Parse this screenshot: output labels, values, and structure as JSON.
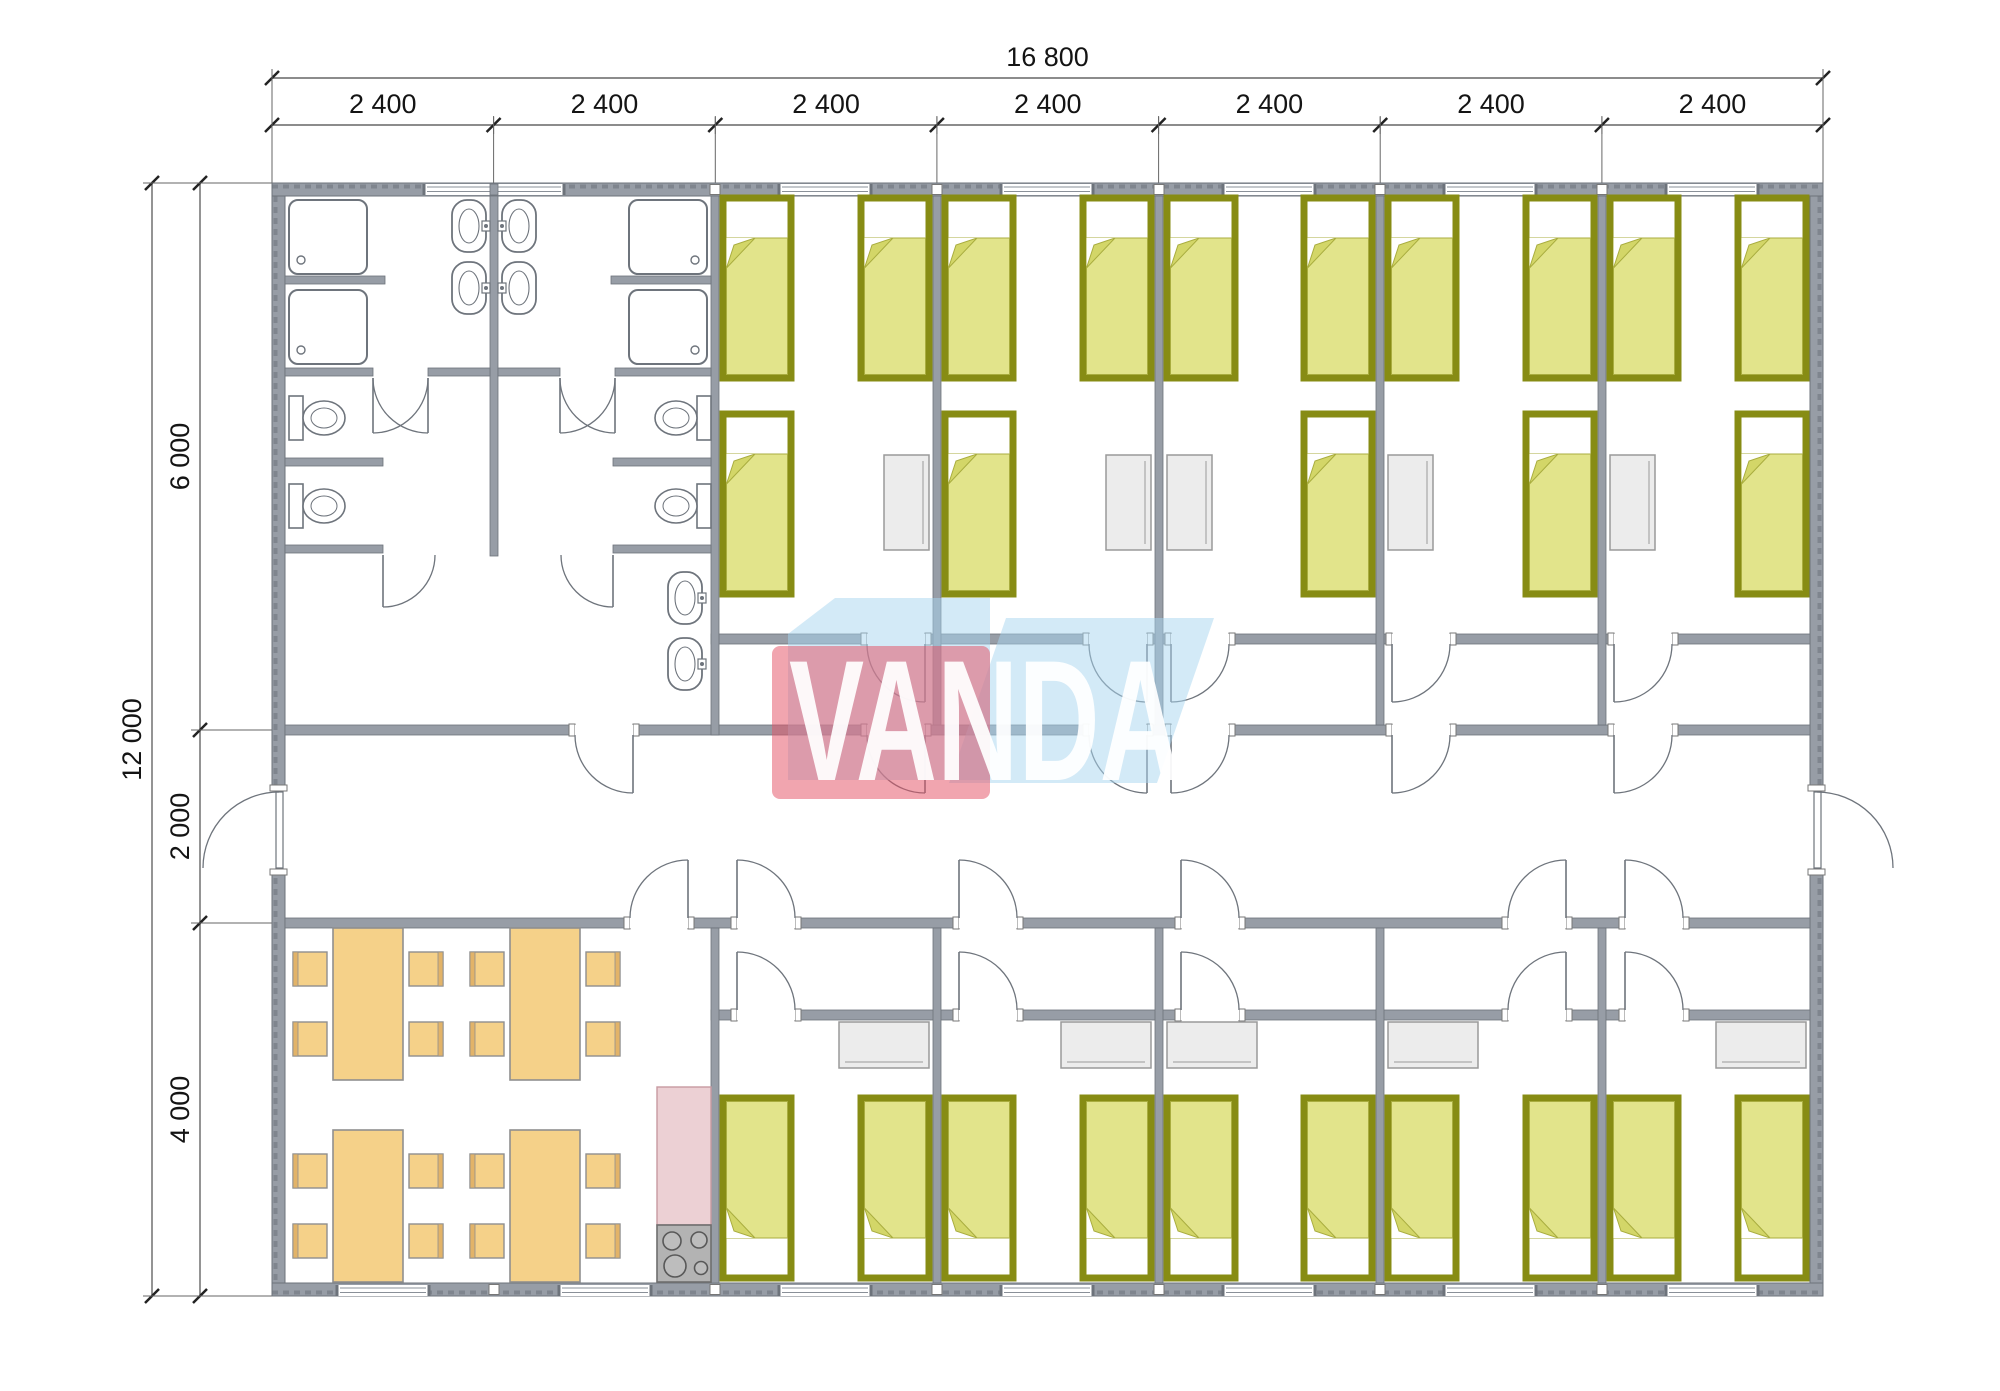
{
  "dimensions": {
    "top_total": "16 800",
    "top_segments": [
      "2 400",
      "2 400",
      "2 400",
      "2 400",
      "2 400",
      "2 400",
      "2 400"
    ],
    "left_total": "12 000",
    "left_segments": [
      "6 000",
      "2 000",
      "4 000"
    ]
  },
  "logo": {
    "text": "VANDA",
    "red": "rgba(228,82,102,0.52)",
    "blue": "rgba(168,214,240,0.50)",
    "text_color": "rgba(255,255,255,0.93)"
  },
  "colors": {
    "wall": "#979da6",
    "wall_edge": "#6d737b",
    "fixture": "#6e747c",
    "bed_frame": "#878c14",
    "bed_fill": "#e2e48b",
    "bed_fold": "#d3d668",
    "bed_fill_edge": "#a9ad3f",
    "gray_furn": "#ececec",
    "gray_furn_edge": "#9a9a9a",
    "dining": "#f5d189",
    "dining_edge": "#8f8f8f",
    "chair_back": "#e2b368",
    "kitchen": "#ecd0d4",
    "kitchen_edge": "#c79aa1",
    "stove": "#b3b3b3",
    "stove_edge": "#6e6e6e",
    "burner": "#bdbdbd",
    "burner_edge": "#585858",
    "dim_text": "#141414",
    "dim_line": "#666",
    "tick": "#222",
    "window_line": "#8a9098"
  },
  "plan": {
    "outer_walls": [
      [
        272,
        183,
        1551,
        13
      ],
      [
        272,
        1283,
        1551,
        13
      ],
      [
        272,
        196,
        13,
        1087
      ],
      [
        1810,
        196,
        13,
        1087
      ]
    ],
    "inner_walls": [
      [
        711,
        634,
        156,
        10
      ],
      [
        925,
        634,
        164,
        10
      ],
      [
        1147,
        634,
        24,
        10
      ],
      [
        1229,
        634,
        163,
        10
      ],
      [
        1450,
        634,
        164,
        10
      ],
      [
        1672,
        634,
        138,
        10
      ],
      [
        285,
        725,
        290,
        10
      ],
      [
        633,
        725,
        234,
        10
      ],
      [
        925,
        725,
        164,
        10
      ],
      [
        1147,
        725,
        24,
        10
      ],
      [
        1229,
        725,
        163,
        10
      ],
      [
        1450,
        725,
        164,
        10
      ],
      [
        1672,
        725,
        138,
        10
      ],
      [
        285,
        918,
        345,
        10
      ],
      [
        688,
        918,
        49,
        10
      ],
      [
        795,
        918,
        164,
        10
      ],
      [
        1017,
        918,
        164,
        10
      ],
      [
        1239,
        918,
        269,
        10
      ],
      [
        1566,
        918,
        59,
        10
      ],
      [
        1683,
        918,
        127,
        10
      ],
      [
        711,
        1010,
        26,
        10
      ],
      [
        795,
        1010,
        164,
        10
      ],
      [
        1017,
        1010,
        164,
        10
      ],
      [
        1239,
        1010,
        269,
        10
      ],
      [
        1566,
        1010,
        59,
        10
      ],
      [
        1683,
        1010,
        127,
        10
      ],
      [
        711,
        196,
        8,
        539
      ],
      [
        933,
        196,
        8,
        529
      ],
      [
        1155,
        196,
        8,
        529
      ],
      [
        1376,
        196,
        8,
        529
      ],
      [
        1598,
        196,
        8,
        529
      ],
      [
        711,
        928,
        8,
        355
      ],
      [
        933,
        928,
        8,
        355
      ],
      [
        1155,
        928,
        8,
        355
      ],
      [
        1376,
        928,
        8,
        355
      ],
      [
        1598,
        928,
        8,
        355
      ],
      [
        490,
        196,
        8,
        360
      ],
      [
        285,
        276,
        100,
        8
      ],
      [
        611,
        276,
        100,
        8
      ],
      [
        285,
        368,
        88,
        8
      ],
      [
        428,
        368,
        62,
        8
      ],
      [
        498,
        368,
        62,
        8
      ],
      [
        615,
        368,
        96,
        8
      ],
      [
        285,
        458,
        98,
        8
      ],
      [
        285,
        545,
        98,
        8
      ],
      [
        613,
        458,
        98,
        8
      ],
      [
        613,
        545,
        98,
        8
      ]
    ],
    "junction_blocks_x": [
      490,
      711,
      933,
      1155,
      1376,
      1598
    ],
    "windows": {
      "top_double": {
        "x": 424,
        "w": 140
      },
      "top": [
        825,
        1047,
        1269,
        1490,
        1712
      ],
      "bottom": [
        383,
        605,
        825,
        1047,
        1269,
        1490,
        1712
      ],
      "w": 92
    },
    "doors": [
      {
        "x": 867,
        "wy": 634,
        "dir": "down",
        "hinge": "right"
      },
      {
        "x": 1089,
        "wy": 634,
        "dir": "down",
        "hinge": "right"
      },
      {
        "x": 1171,
        "wy": 634,
        "dir": "down",
        "hinge": "left"
      },
      {
        "x": 1392,
        "wy": 634,
        "dir": "down",
        "hinge": "left"
      },
      {
        "x": 1614,
        "wy": 634,
        "dir": "down",
        "hinge": "left"
      },
      {
        "x": 575,
        "wy": 725,
        "dir": "down",
        "hinge": "right"
      },
      {
        "x": 867,
        "wy": 725,
        "dir": "down",
        "hinge": "right"
      },
      {
        "x": 1089,
        "wy": 725,
        "dir": "down",
        "hinge": "right"
      },
      {
        "x": 1171,
        "wy": 725,
        "dir": "down",
        "hinge": "left"
      },
      {
        "x": 1392,
        "wy": 725,
        "dir": "down",
        "hinge": "left"
      },
      {
        "x": 1614,
        "wy": 725,
        "dir": "down",
        "hinge": "left"
      },
      {
        "x": 630,
        "wy": 918,
        "dir": "up",
        "hinge": "right"
      },
      {
        "x": 737,
        "wy": 918,
        "dir": "up",
        "hinge": "left"
      },
      {
        "x": 959,
        "wy": 918,
        "dir": "up",
        "hinge": "left"
      },
      {
        "x": 1181,
        "wy": 918,
        "dir": "up",
        "hinge": "left"
      },
      {
        "x": 1508,
        "wy": 918,
        "dir": "up",
        "hinge": "right"
      },
      {
        "x": 1625,
        "wy": 918,
        "dir": "up",
        "hinge": "left"
      },
      {
        "x": 737,
        "wy": 1010,
        "dir": "up",
        "hinge": "left"
      },
      {
        "x": 959,
        "wy": 1010,
        "dir": "up",
        "hinge": "left"
      },
      {
        "x": 1181,
        "wy": 1010,
        "dir": "up",
        "hinge": "left"
      },
      {
        "x": 1508,
        "wy": 1010,
        "dir": "up",
        "hinge": "right"
      },
      {
        "x": 1625,
        "wy": 1010,
        "dir": "up",
        "hinge": "left"
      },
      {
        "x": 373,
        "wy": 368,
        "dir": "down",
        "hinge": "left",
        "len": 55,
        "nojamb": true
      },
      {
        "x": 373,
        "wy": 368,
        "dir": "down",
        "hinge": "right",
        "len": 55,
        "nojamb": true
      },
      {
        "x": 560,
        "wy": 368,
        "dir": "down",
        "hinge": "left",
        "len": 55,
        "nojamb": true
      },
      {
        "x": 560,
        "wy": 368,
        "dir": "down",
        "hinge": "right",
        "len": 55,
        "nojamb": true
      },
      {
        "x": 383,
        "wy": 545,
        "dir": "down",
        "hinge": "left",
        "len": 52,
        "nojamb": true
      },
      {
        "x": 561,
        "wy": 545,
        "dir": "down",
        "hinge": "right",
        "len": 52,
        "nojamb": true
      }
    ],
    "exterior_doors": [
      {
        "side": "left",
        "y": 792,
        "h": 76
      },
      {
        "side": "right",
        "y": 792,
        "h": 76
      }
    ],
    "beds": {
      "w": 68,
      "h": 180,
      "items": [
        [
          723,
          198,
          "top"
        ],
        [
          861,
          198,
          "top"
        ],
        [
          945,
          198,
          "top"
        ],
        [
          1083,
          198,
          "top"
        ],
        [
          1167,
          198,
          "top"
        ],
        [
          1304,
          198,
          "top"
        ],
        [
          1388,
          198,
          "top"
        ],
        [
          1526,
          198,
          "top"
        ],
        [
          1610,
          198,
          "top"
        ],
        [
          1738,
          198,
          "top"
        ],
        [
          723,
          414,
          "top"
        ],
        [
          945,
          414,
          "top"
        ],
        [
          1304,
          414,
          "top"
        ],
        [
          1526,
          414,
          "top"
        ],
        [
          1738,
          414,
          "top"
        ],
        [
          723,
          1098,
          "bottom"
        ],
        [
          861,
          1098,
          "bottom"
        ],
        [
          945,
          1098,
          "bottom"
        ],
        [
          1083,
          1098,
          "bottom"
        ],
        [
          1167,
          1098,
          "bottom"
        ],
        [
          1304,
          1098,
          "bottom"
        ],
        [
          1388,
          1098,
          "bottom"
        ],
        [
          1526,
          1098,
          "bottom"
        ],
        [
          1610,
          1098,
          "bottom"
        ],
        [
          1738,
          1098,
          "bottom"
        ]
      ]
    },
    "nightstands": {
      "w": 45,
      "h": 95,
      "items": [
        [
          884,
          455
        ],
        [
          1106,
          455
        ],
        [
          1167,
          455
        ],
        [
          1388,
          455
        ],
        [
          1610,
          455
        ]
      ]
    },
    "wardrobes": {
      "w": 90,
      "h": 46,
      "items": [
        [
          839,
          1022
        ],
        [
          1061,
          1022
        ],
        [
          1167,
          1022
        ],
        [
          1388,
          1022
        ],
        [
          1716,
          1022
        ]
      ]
    },
    "dining": {
      "table_w": 70,
      "table_h": 152,
      "chair": 34,
      "tables": [
        [
          333,
          928
        ],
        [
          510,
          928
        ],
        [
          333,
          1130
        ],
        [
          510,
          1130
        ]
      ]
    },
    "kitchen": {
      "counter": [
        657,
        1087,
        54,
        138
      ],
      "stove": [
        657,
        1225,
        54,
        57
      ],
      "burners": [
        [
          672,
          1241,
          9
        ],
        [
          699,
          1240,
          8
        ],
        [
          675,
          1266,
          11
        ],
        [
          701,
          1268,
          6.5
        ]
      ]
    },
    "sanitary": {
      "showers": [
        [
          289,
          200,
          "l"
        ],
        [
          289,
          290,
          "l"
        ],
        [
          629,
          200,
          "r"
        ],
        [
          629,
          290,
          "r"
        ]
      ],
      "shower_w": 78,
      "shower_h": 74,
      "bath_sinks": [
        [
          452,
          200,
          "right"
        ],
        [
          452,
          262,
          "right"
        ],
        [
          502,
          200,
          "left"
        ],
        [
          502,
          262,
          "left"
        ]
      ],
      "vest_sinks": [
        [
          668,
          572,
          "right"
        ],
        [
          668,
          638,
          "right"
        ]
      ],
      "sink_w": 34,
      "sink_h": 52,
      "toilets": [
        [
          289,
          396,
          "left"
        ],
        [
          289,
          484,
          "left"
        ],
        [
          697,
          396,
          "right"
        ],
        [
          697,
          484,
          "right"
        ]
      ]
    },
    "dim_geometry": {
      "top_total_y": 78,
      "top_seg_y": 125,
      "x_ticks": [
        272,
        493.6,
        715.3,
        936.9,
        1158.6,
        1380.2,
        1601.9,
        1823
      ],
      "left_total_x": 152,
      "left_seg_x": 200,
      "y_ticks": [
        183,
        730,
        923,
        1296
      ]
    },
    "logo_geometry": {
      "blueA": "M 835 598 L 990 598 L 990 780 L 788 780 L 788 634 Z",
      "blueB": "M 1006 618 L 1214 618 L 1157 783 L 949 783 Z",
      "red": [
        772,
        646,
        218,
        153
      ],
      "text_x": 985,
      "text_y": 780,
      "text_length": 392,
      "font_size": 172
    }
  }
}
